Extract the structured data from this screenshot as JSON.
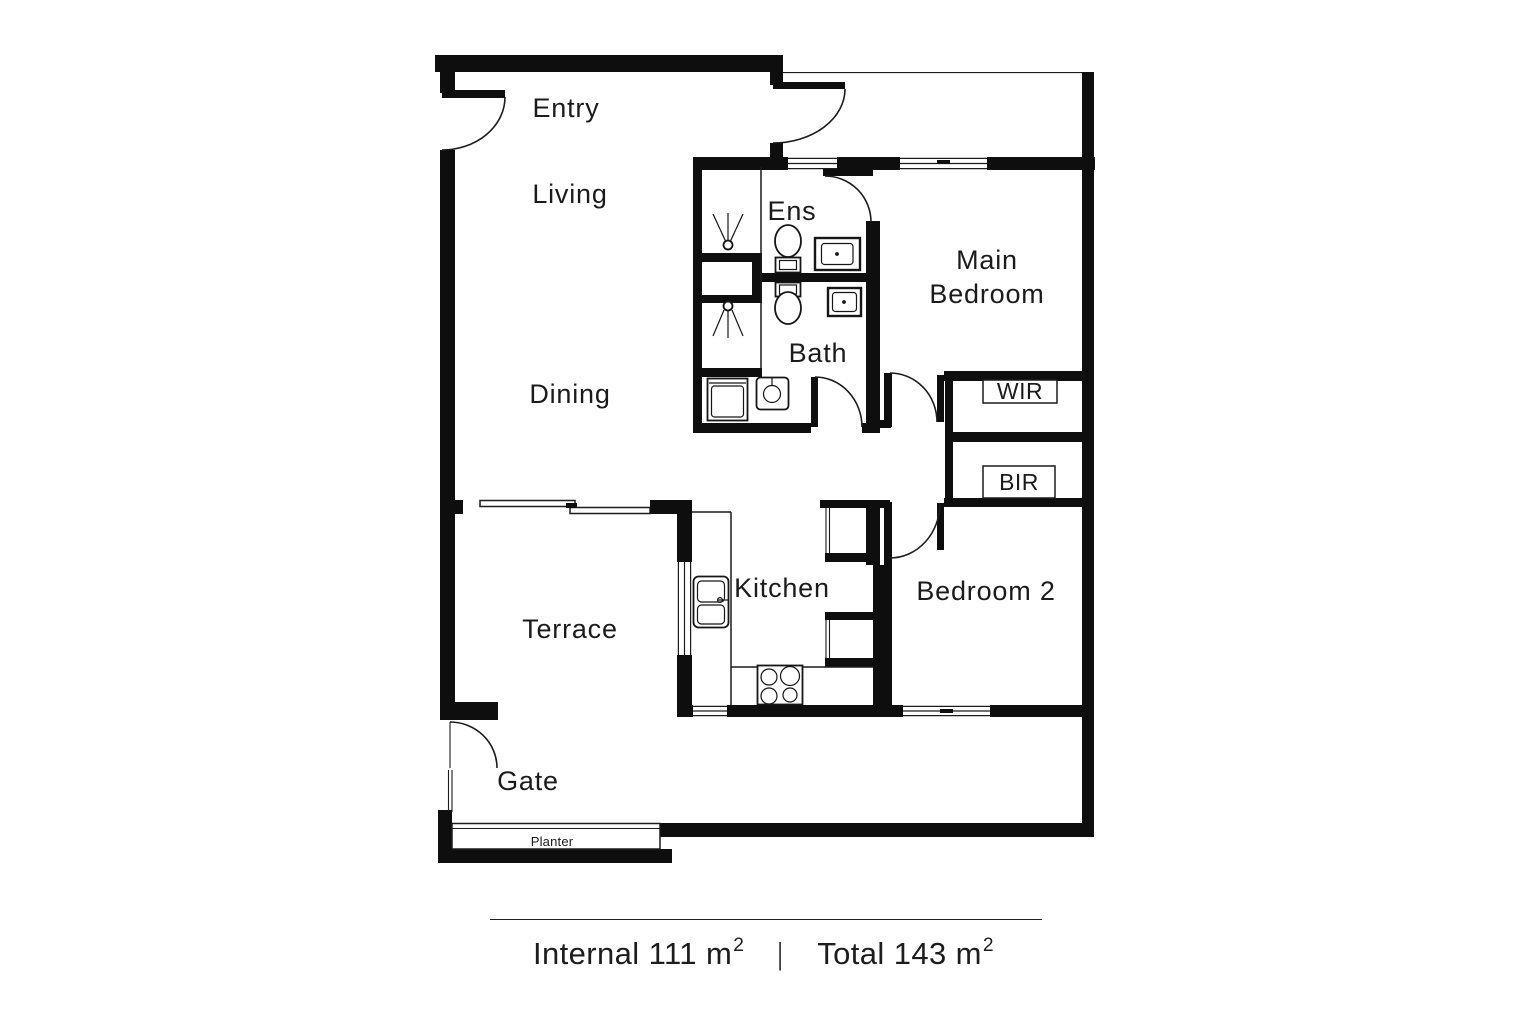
{
  "rooms": {
    "entry": "Entry",
    "living": "Living",
    "dining": "Dining",
    "ens": "Ens",
    "bath": "Bath",
    "main_bedroom_line1": "Main",
    "main_bedroom_line2": "Bedroom",
    "wir": "WIR",
    "bir": "BIR",
    "kitchen": "Kitchen",
    "bedroom2": "Bedroom 2",
    "terrace": "Terrace",
    "gate": "Gate",
    "planter": "Planter"
  },
  "footer": {
    "internal_label": "Internal",
    "internal_value": "111",
    "area_unit": "m",
    "area_exponent": "2",
    "separator": "|",
    "total_label": "Total",
    "total_value": "143"
  },
  "colors": {
    "wall": "#0e0e0e",
    "line": "#1c1c1c",
    "background": "#ffffff",
    "text": "#1b1b1b"
  }
}
